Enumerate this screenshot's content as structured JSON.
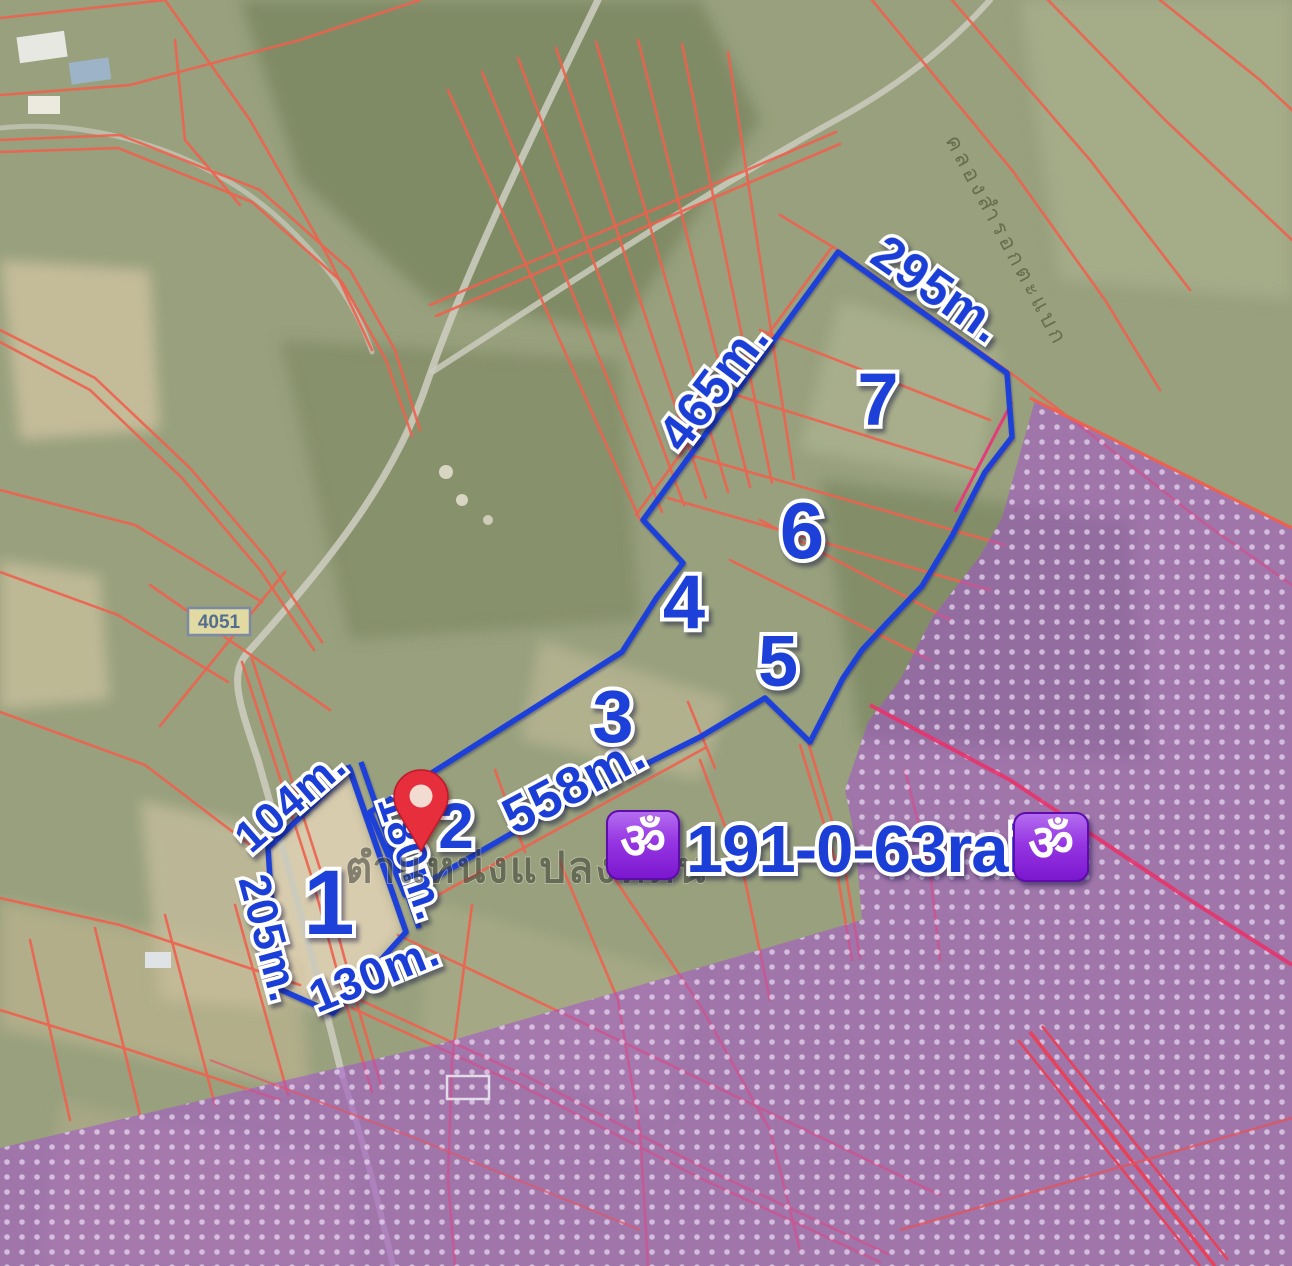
{
  "map": {
    "title": "Satellite land-plot map",
    "watermark": "ตำแหน่งแปลงที่ดิน",
    "canal_label": "คลองสำรอกตะแบก",
    "road_sign_label": "4051",
    "om_icon": "ॐ",
    "area_total": "191-0-63rai.",
    "colors": {
      "plot_outline_blue": "#1d41d8",
      "parcel_line_red": "#ef614e",
      "zoning_overlay_purple": "#a44fd2",
      "pin_red": "#e62e3c",
      "om_badge_purple": "#8f2ae0",
      "label_blue": "#1b3ed6"
    }
  },
  "plots": [
    {
      "number": "1"
    },
    {
      "number": "2"
    },
    {
      "number": "3"
    },
    {
      "number": "4"
    },
    {
      "number": "5"
    },
    {
      "number": "6"
    },
    {
      "number": "7"
    }
  ],
  "measurements": [
    {
      "label": "295m."
    },
    {
      "label": "465m."
    },
    {
      "label": "558m."
    },
    {
      "label": "104m."
    },
    {
      "label": "180m."
    },
    {
      "label": "130m."
    },
    {
      "label": "205m."
    }
  ]
}
